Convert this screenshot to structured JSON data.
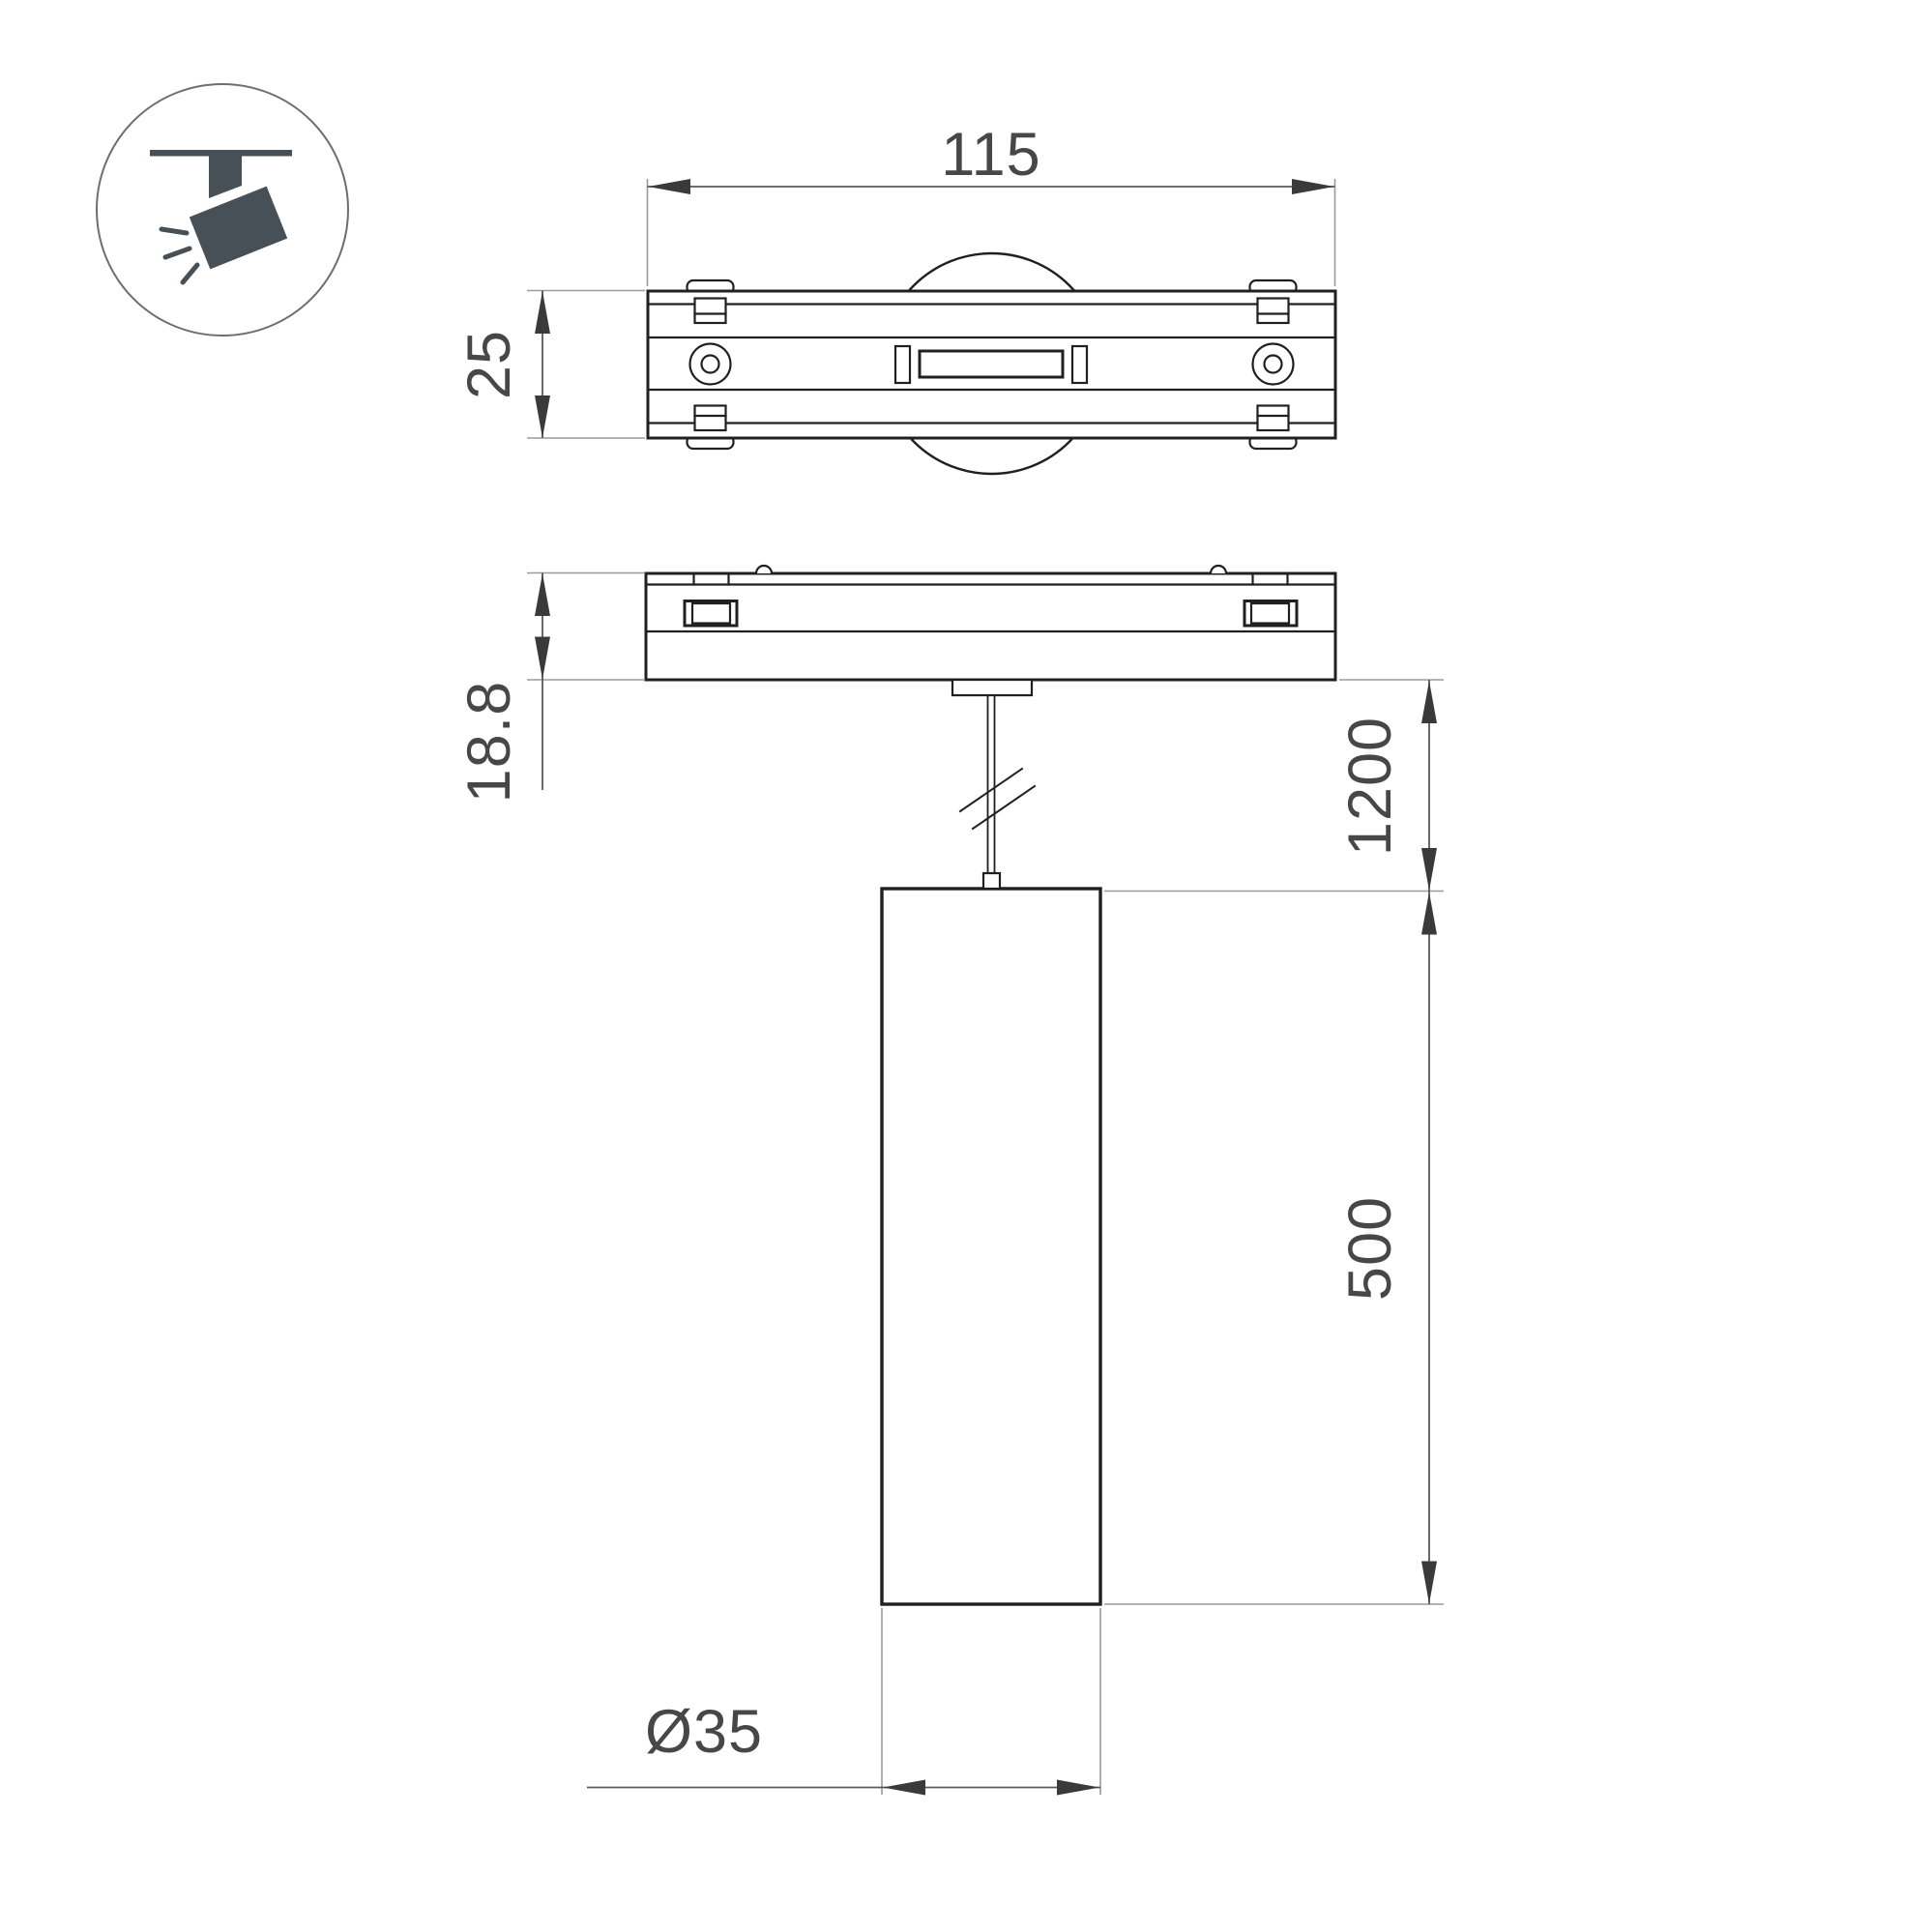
{
  "drawing": {
    "dim_track_width": "115",
    "dim_track_depth": "25",
    "dim_module_height": "18.8",
    "dim_suspension_length": "1200",
    "dim_body_length": "500",
    "dim_body_diameter": "Ø35"
  },
  "colors": {
    "outline": "#202020",
    "dimension_line": "#5a5a5a",
    "extension_line": "#9b9b9b",
    "dimension_text": "#474747",
    "icon_fill": "#475056",
    "background": "#ffffff"
  }
}
